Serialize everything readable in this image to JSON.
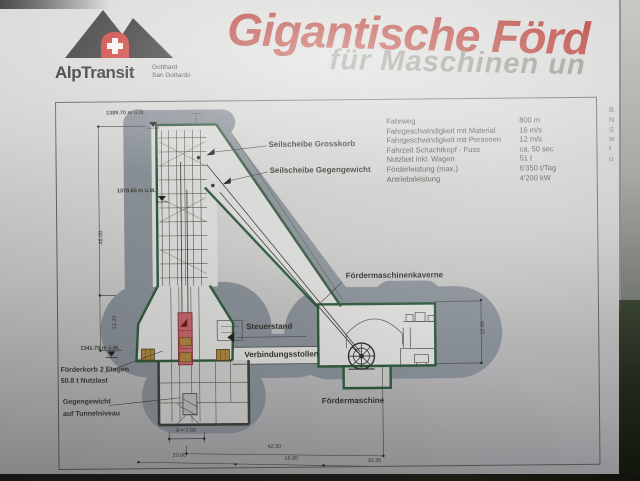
{
  "poster": {
    "title": "Gigantische Förd",
    "subtitle": "für Maschinen un",
    "logo": {
      "brand": "AlpTransit",
      "region_line1": "Gotthard",
      "region_line2": "San Gottardo"
    }
  },
  "specs": {
    "rows": [
      {
        "label": "Fahrweg",
        "value": "800 m"
      },
      {
        "label": "Fahrgeschwindigkeit mit Material",
        "value": "16 m/s"
      },
      {
        "label": "Fahrgeschwindigkeit mit Personen",
        "value": "12 m/s"
      },
      {
        "label": "Fahrzeit Schachtkopf - Fuss",
        "value": "ca. 50 sec"
      },
      {
        "label": "Nutzlast inkl. Wagen",
        "value": "51 t"
      },
      {
        "label": "Förderleistung (max.)",
        "value": "6'350 t/Tag"
      },
      {
        "label": "Antriebsleistung",
        "value": "4'200 kW"
      }
    ]
  },
  "diagram": {
    "labels": {
      "sheave_main": "Seilscheibe Grosskorb",
      "sheave_counterweight": "Seilscheibe Gegengewicht",
      "machine_cavern": "Fördermaschinenkaverne",
      "control_stand": "Steuerstand",
      "connecting_gallery": "Verbindungsstollen",
      "hoisting_machine": "Fördermaschine",
      "cage_line1": "Förderkorb 2 Etagen",
      "cage_line2": "50.8 t Nutzlast",
      "counterweight_line1": "Gegengewicht",
      "counterweight_line2": "auf Tunnelniveau"
    },
    "elevations": [
      "1389.70 m ü.M.",
      "1379.65 m ü.M.",
      "1341.70 m ü.M."
    ],
    "dimensions": {
      "shaft_height": "48.00",
      "lower_height": "13.20",
      "cavern_height": "12.90",
      "shaft_diameter": "d = 7.00",
      "span_top": "42.30",
      "span_b1": "20.00",
      "span_b2": "16.80",
      "span_b3": "33.35"
    }
  },
  "edge_fragments": [
    "B",
    "N",
    "S",
    "w",
    "f",
    "u"
  ],
  "colors": {
    "title_red": "#b23128",
    "subtitle_gray": "#8d8d86",
    "structure_green": "#2f5a3e",
    "rock_gray": "#868d94",
    "cage_red": "#c05a60",
    "wagon_orange": "#a98440",
    "logo_red": "#c8312b"
  }
}
